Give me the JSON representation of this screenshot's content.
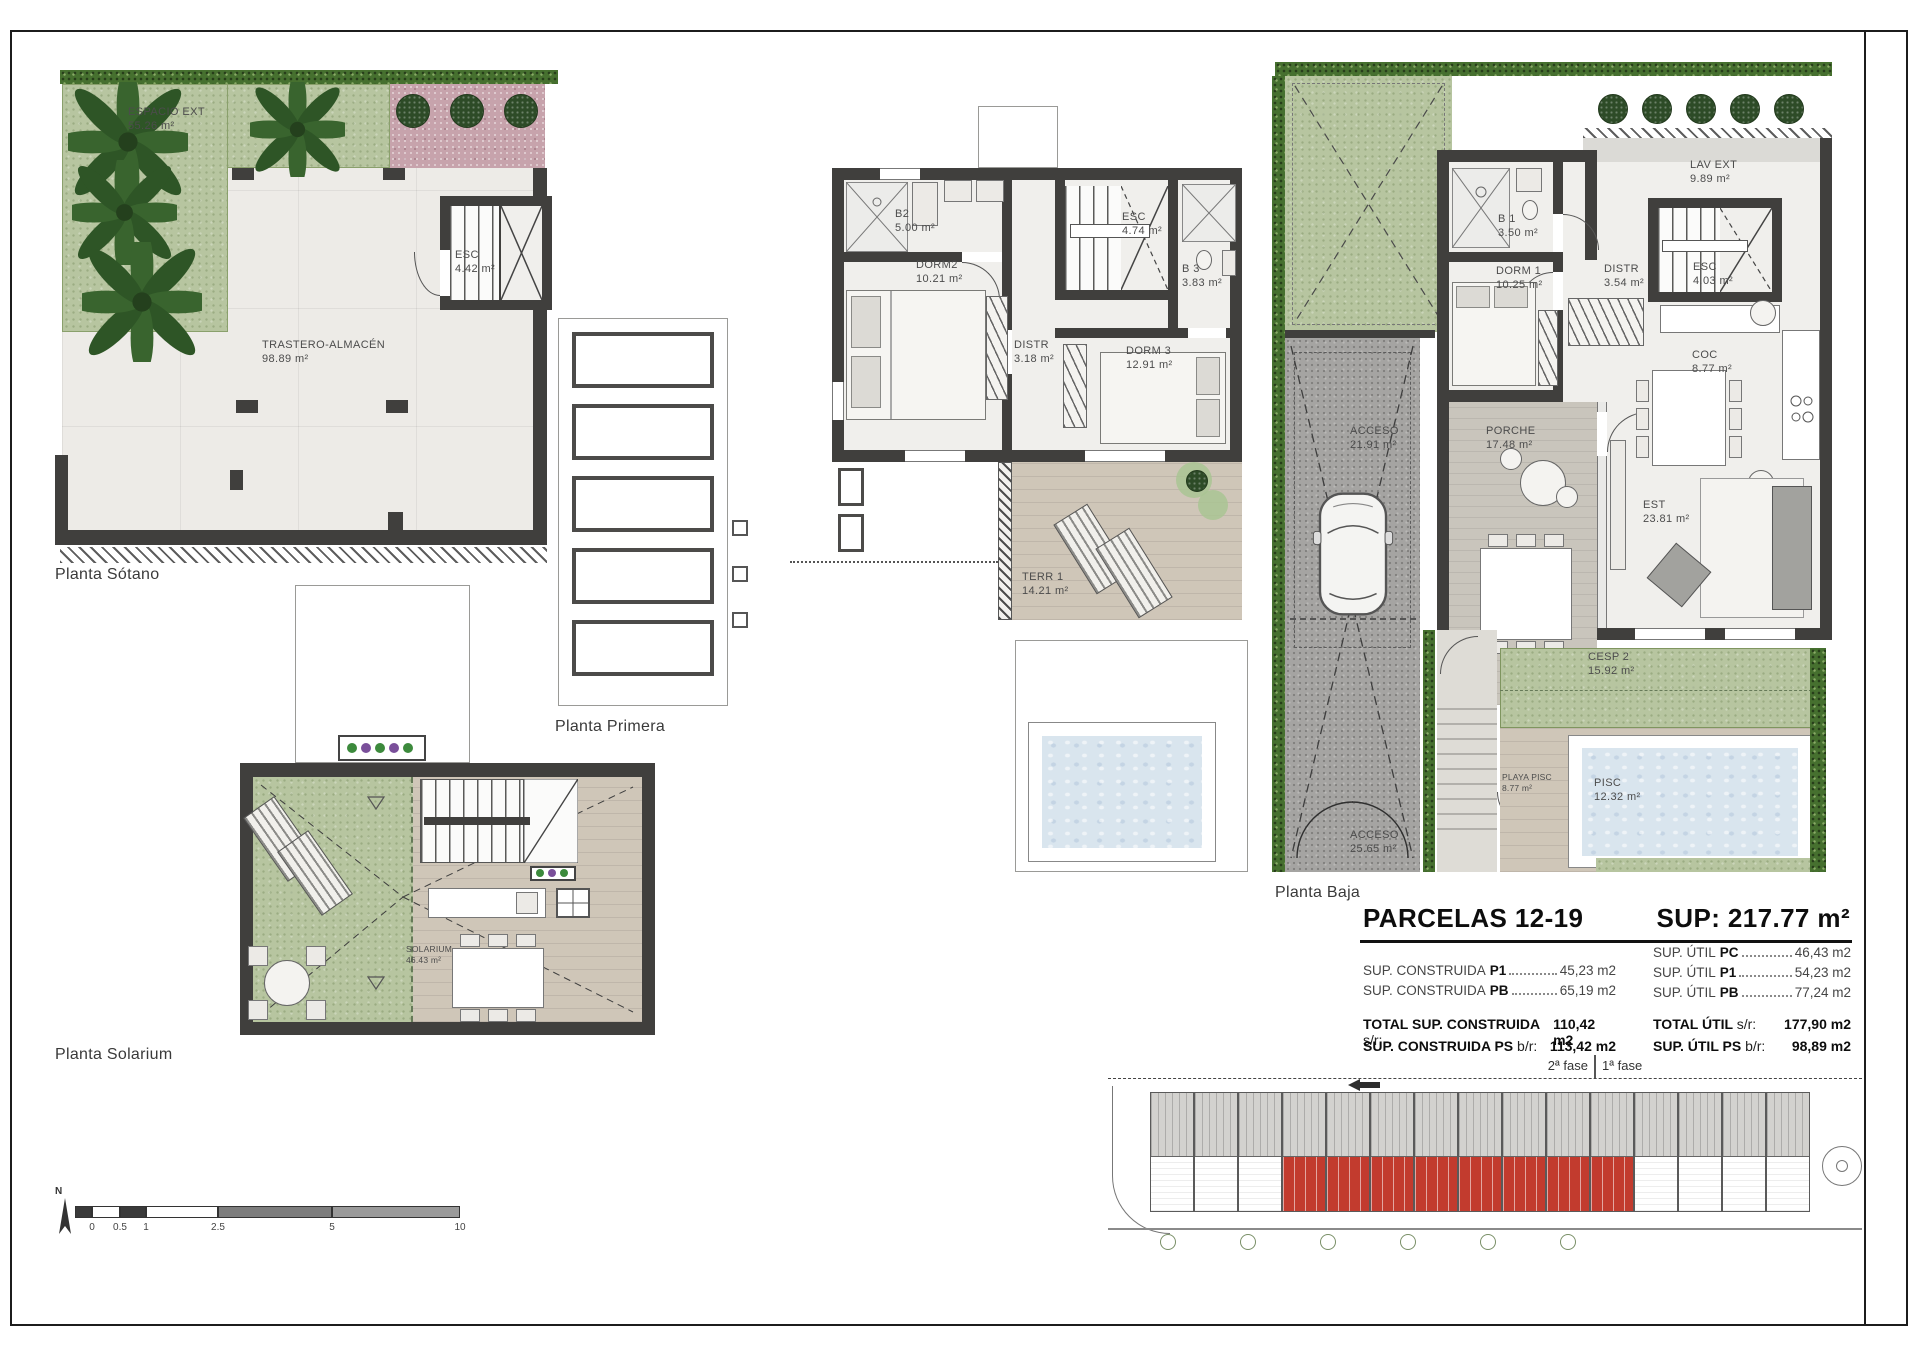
{
  "plans": {
    "sotano": {
      "caption": "Planta Sótano",
      "rooms": {
        "espacio_ext": {
          "name": "ESPACIO EXT",
          "area": "55.26 m²"
        },
        "trastero": {
          "name": "TRASTERO-ALMACÉN",
          "area": "98.89 m²"
        },
        "esc": {
          "name": "ESC",
          "area": "4.42 m²"
        }
      }
    },
    "primera": {
      "caption": "Planta Primera",
      "rooms": {
        "b2": {
          "name": "B2",
          "area": "5.00 m²"
        },
        "dorm2": {
          "name": "DORM2",
          "area": "10.21 m²"
        },
        "distr": {
          "name": "DISTR",
          "area": "3.18 m²"
        },
        "esc": {
          "name": "ESC",
          "area": "4.74 m²"
        },
        "b3": {
          "name": "B 3",
          "area": "3.83 m²"
        },
        "dorm3": {
          "name": "DORM 3",
          "area": "12.91 m²"
        },
        "terr1": {
          "name": "TERR 1",
          "area": "14.21 m²"
        }
      }
    },
    "baja": {
      "caption": "Planta Baja",
      "rooms": {
        "lav_ext": {
          "name": "LAV EXT",
          "area": "9.89 m²"
        },
        "b1": {
          "name": "B 1",
          "area": "3.50 m²"
        },
        "dorm1": {
          "name": "DORM 1",
          "area": "10.25 m²"
        },
        "distr": {
          "name": "DISTR",
          "area": "3.54 m²"
        },
        "esc": {
          "name": "ESC",
          "area": "4.03 m²"
        },
        "coc": {
          "name": "COC",
          "area": "8.77 m²"
        },
        "acceso_sup": {
          "name": "ACCESO",
          "area": "21.91 m²"
        },
        "porche": {
          "name": "PORCHE",
          "area": "17.48 m²"
        },
        "est": {
          "name": "EST",
          "area": "23.81 m²"
        },
        "cesp2": {
          "name": "CESP 2",
          "area": "15.92 m²"
        },
        "playa_pisc": {
          "name": "PLAYA PISC",
          "area": "8.77 m²"
        },
        "pisc": {
          "name": "PISC",
          "area": "12.32 m²"
        },
        "acceso_inf": {
          "name": "ACCESO",
          "area": "25.65 m²"
        }
      }
    },
    "solarium": {
      "caption": "Planta Solarium",
      "rooms": {
        "solarium": {
          "name": "SOLARIUM",
          "area": "46.43 m²"
        }
      }
    }
  },
  "summary": {
    "title": "PARCELAS 12-19",
    "sup": "SUP: 217.77 m²",
    "construida": {
      "rows": [
        {
          "label": "SUP. CONSTRUIDA",
          "key": "P1",
          "value": "45,23 m2"
        },
        {
          "label": "SUP. CONSTRUIDA",
          "key": "PB",
          "value": "65,19 m2"
        }
      ],
      "totals": [
        {
          "label": "TOTAL SUP. CONSTRUIDA",
          "suffix": "s/r:",
          "value": "110,42 m2"
        },
        {
          "label": "SUP. CONSTRUIDA PS",
          "suffix": "b/r:",
          "value": "113,42 m2"
        }
      ]
    },
    "util": {
      "rows": [
        {
          "label": "SUP. ÚTIL",
          "key": "PC",
          "value": "46,43 m2"
        },
        {
          "label": "SUP. ÚTIL",
          "key": "P1",
          "value": "54,23 m2"
        },
        {
          "label": "SUP. ÚTIL",
          "key": "PB",
          "value": "77,24 m2"
        }
      ],
      "totals": [
        {
          "label": "TOTAL ÚTIL",
          "suffix": "s/r:",
          "value": "177,90 m2"
        },
        {
          "label": "SUP. ÚTIL PS",
          "suffix": "b/r:",
          "value": "98,89 m2"
        }
      ]
    },
    "fase2": "2ª fase",
    "fase1": "1ª fase"
  },
  "scalebar": {
    "north": "N",
    "labels": [
      "0",
      "0.5",
      "1",
      "2.5",
      "5",
      "10"
    ]
  }
}
